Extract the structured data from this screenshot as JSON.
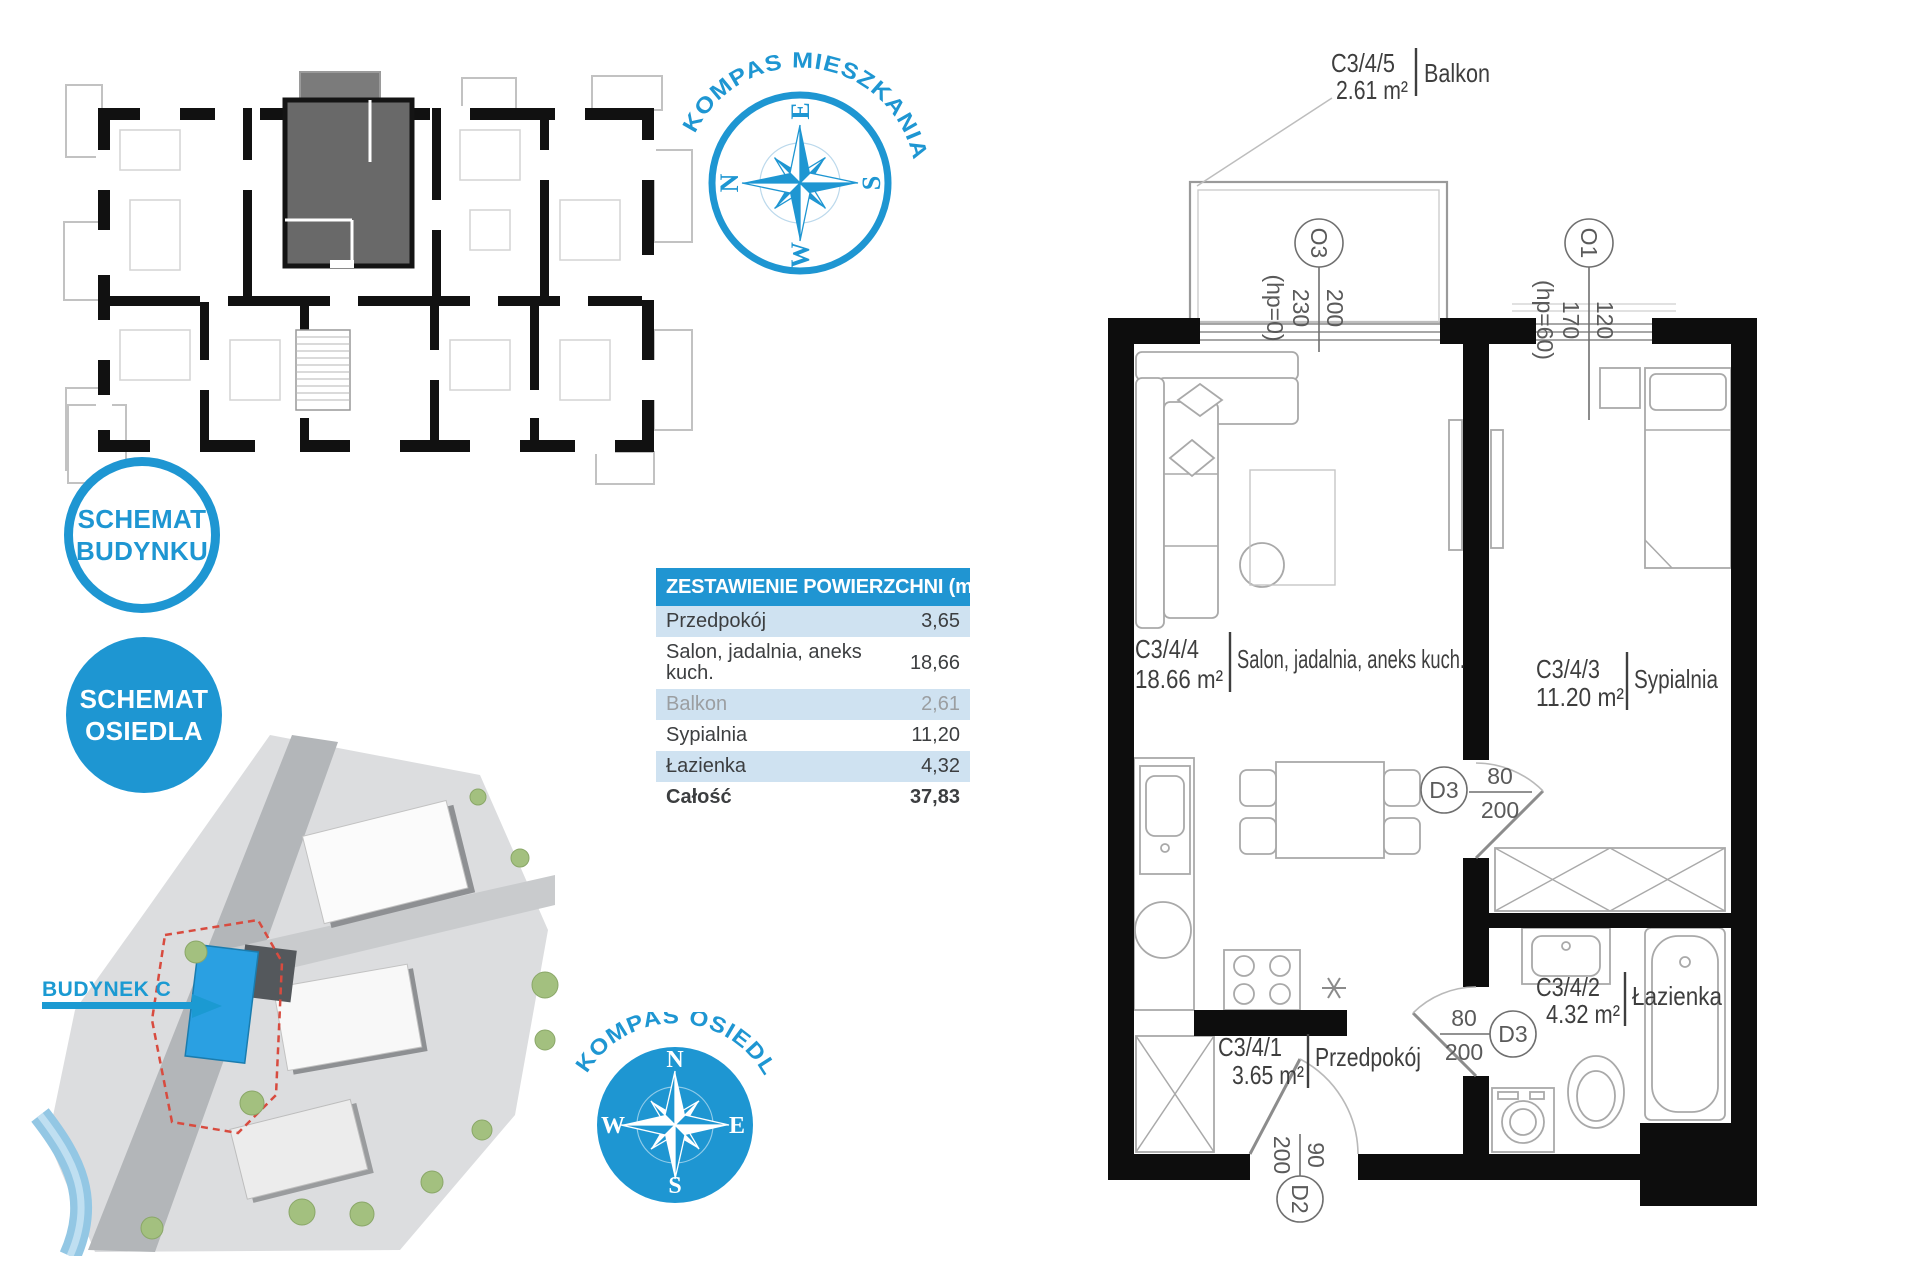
{
  "colors": {
    "accent_blue": "#1e96d2",
    "table_header_blue": "#2095d2",
    "table_row_blue": "#cfe2f1",
    "highlight_unit_gray": "#696969",
    "site_building_blue": "#2aa0e2",
    "parcel_dashed_red": "#d84b3f"
  },
  "badges": {
    "building": {
      "line1": "SCHEMAT",
      "line2": "BUDYNKU"
    },
    "estate": {
      "line1": "SCHEMAT",
      "line2": "OSIEDLA"
    }
  },
  "compass_apartment": {
    "title": "KOMPAS MIESZKANIA",
    "n": "N",
    "e": "E",
    "s": "S",
    "w": "W"
  },
  "compass_estate": {
    "title": "KOMPAS OSIEDLA",
    "n": "N",
    "e": "E",
    "s": "S",
    "w": "W"
  },
  "site_map": {
    "building_label": "BUDYNEK C"
  },
  "table": {
    "header": "ZESTAWIENIE POWIERZCHNI (m²)",
    "rows": [
      {
        "name": "Przedpokój",
        "value": "3,65"
      },
      {
        "name": "Salon, jadalnia, aneks kuch.",
        "value": "18,66"
      },
      {
        "name": "Balkon",
        "value": "2,61"
      },
      {
        "name": "Sypialnia",
        "value": "11,20"
      },
      {
        "name": "Łazienka",
        "value": "4,32"
      },
      {
        "name": "Całość",
        "value": "37,83"
      }
    ]
  },
  "plan": {
    "balkon": {
      "code": "C3/4/5",
      "area": "2.61 m²",
      "name": "Balkon"
    },
    "salon": {
      "code": "C3/4/4",
      "area": "18.66 m²",
      "name": "Salon, jadalnia, aneks kuch."
    },
    "sypialnia": {
      "code": "C3/4/3",
      "area": "11.20 m²",
      "name": "Sypialnia"
    },
    "lazienka": {
      "code": "C3/4/2",
      "area": "4.32 m²",
      "name": "Łazienka"
    },
    "przedpokoj": {
      "code": "C3/4/1",
      "area": "3.65 m²",
      "name": "Przedpokój"
    },
    "o3": {
      "id": "O3",
      "width": "200",
      "height": "230",
      "sill": "(hp=0)"
    },
    "o1": {
      "id": "O1",
      "width": "120",
      "height": "170",
      "sill": "(hp=60)"
    },
    "d3a": {
      "id": "D3",
      "width": "80",
      "height": "200"
    },
    "d3b": {
      "id": "D3",
      "width": "80",
      "height": "200"
    },
    "d2": {
      "id": "D2",
      "width": "90",
      "height": "200"
    }
  }
}
